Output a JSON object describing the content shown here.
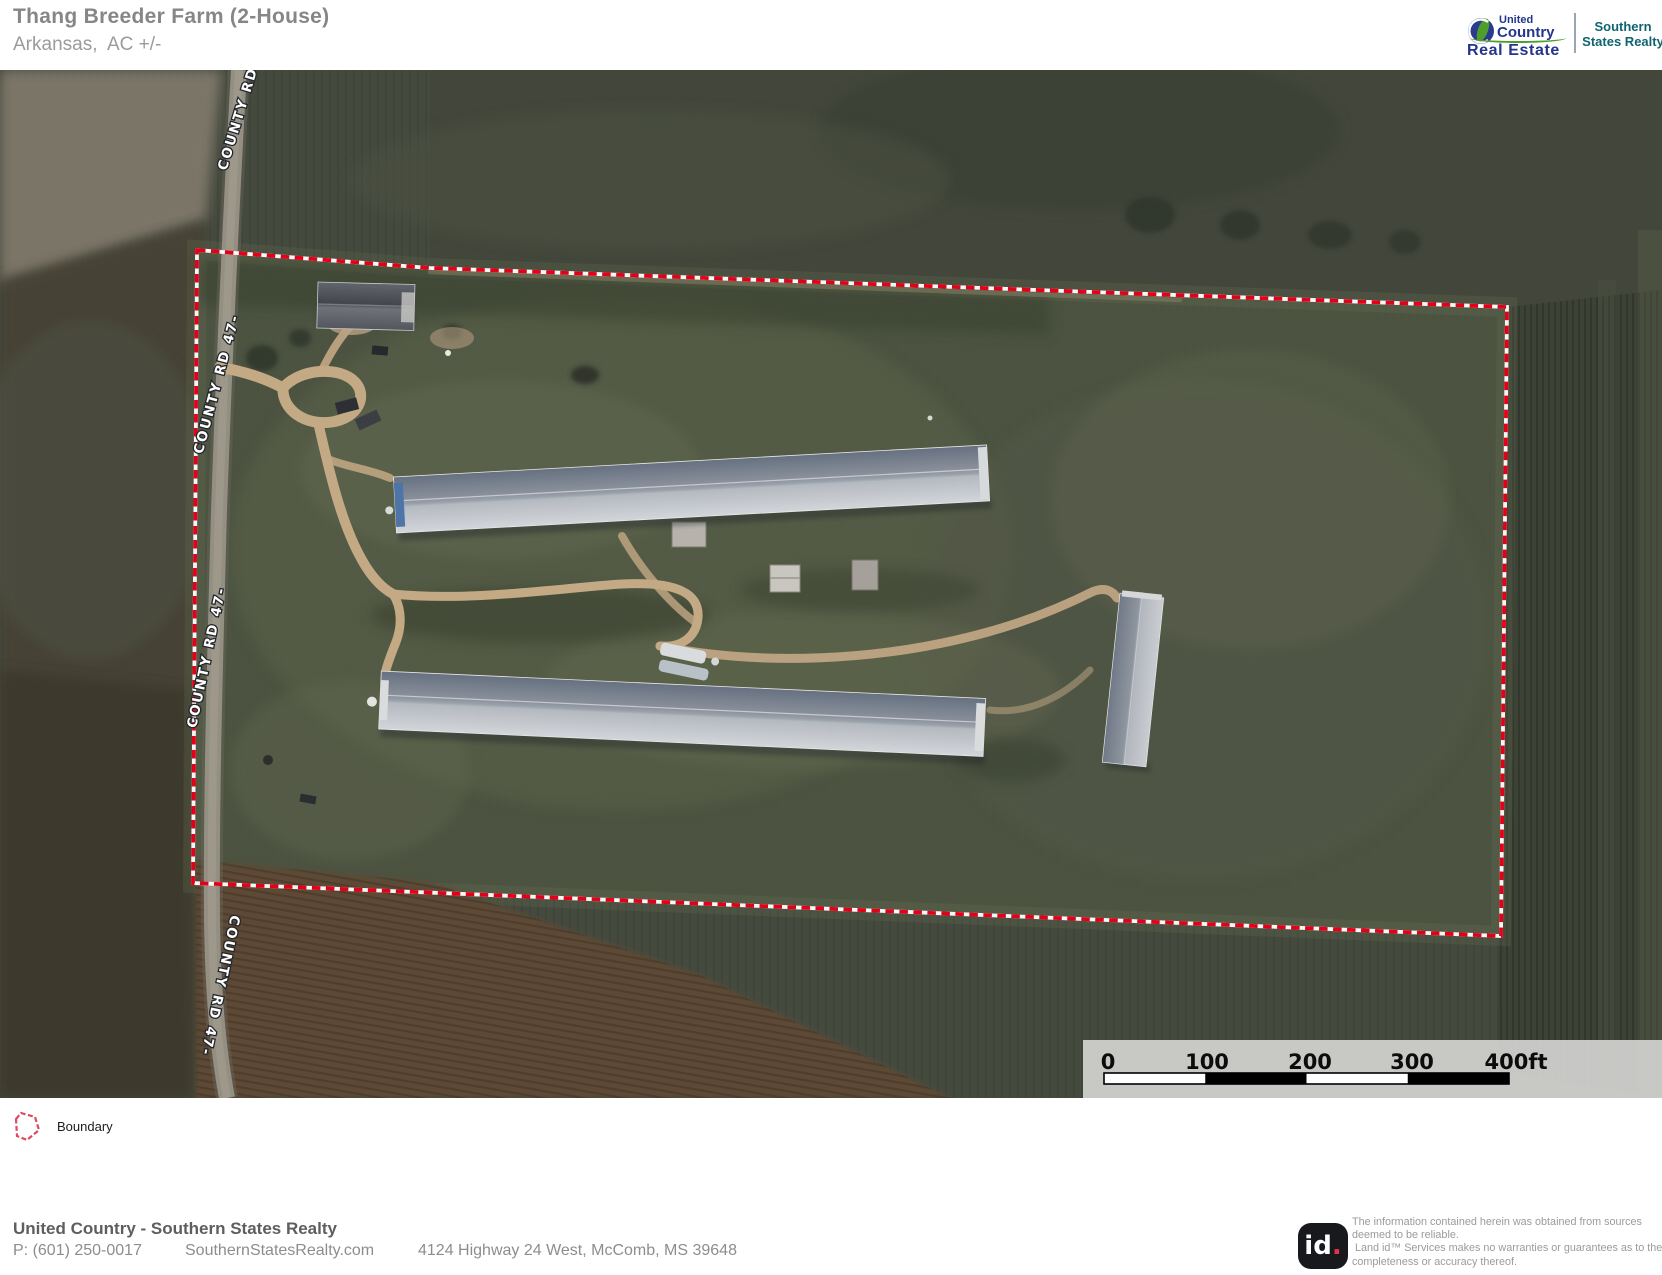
{
  "header": {
    "title": "Thang Breeder Farm (2-House)",
    "subtitle": "Arkansas,  AC +/-",
    "brand": {
      "uc_top": "United",
      "uc_mid": "Country",
      "uc_bottom": "Real Estate",
      "ssr_top": "Southern",
      "ssr_bottom": "States Realty"
    }
  },
  "map": {
    "road_labels": [
      "COUNTY RD",
      "COUNTY RD 47-",
      "COUNTY RD 47-",
      "COUNTY RD 47-"
    ],
    "colors": {
      "boundary_red": "#e50019",
      "boundary_white": "#ffffff",
      "field_dark": "#454a3e",
      "plowed_brown": "#5d4a36",
      "dirt_tan": "#c4a985",
      "roof_dark": "#667080",
      "roof_light": "#d2d5d9"
    },
    "scalebar": {
      "ticks": [
        "0",
        "100",
        "200",
        "300",
        "400ft"
      ]
    }
  },
  "legend": {
    "boundary_label": "Boundary"
  },
  "footer": {
    "company": "United Country - Southern States Realty",
    "phone": "P: (601) 250-0017",
    "website": "SouthernStatesRealty.com",
    "address": "4124 Highway 24 West, McComb, MS 39648",
    "id_text": "id",
    "id_dot": ".",
    "disclaimer": {
      "line1": "The information contained herein was obtained from sources",
      "line2": "deemed to be reliable.",
      "line3": "Land id™ Services makes no warranties or guarantees as to the",
      "line4": "completeness or accuracy thereof."
    }
  }
}
